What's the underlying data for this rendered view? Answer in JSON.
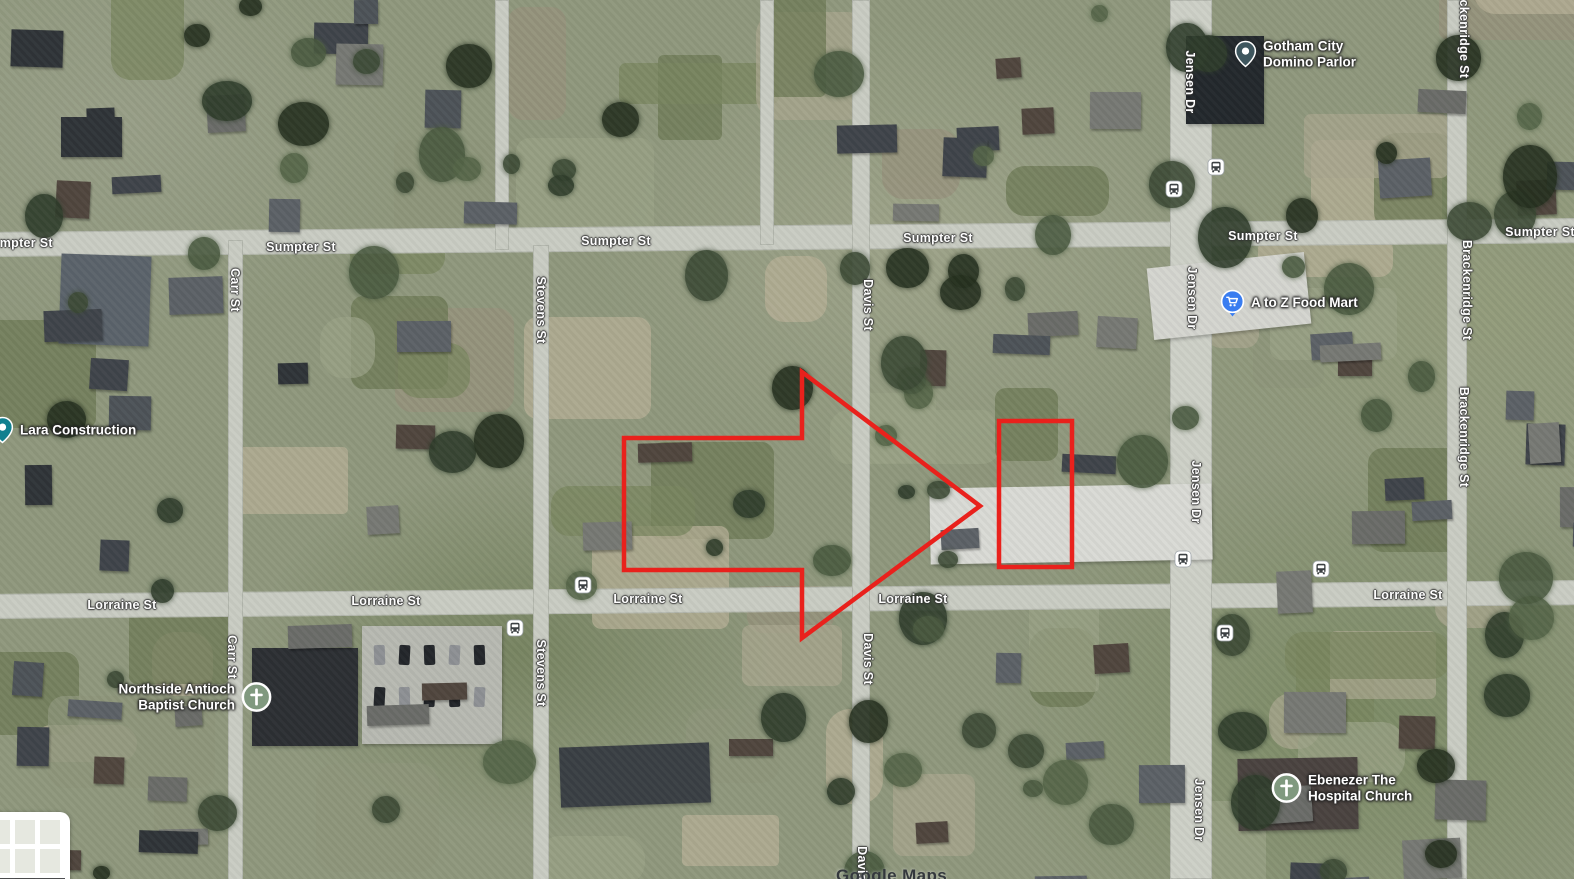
{
  "map": {
    "watermark": "Google Maps"
  },
  "annotations": {
    "color": "#e9211c",
    "stroke_width": 4.5,
    "arrow_polygon_points": "624,438 802,438 802,372 980,506 802,638 802,570 624,570",
    "parcel_rect": {
      "x": 999,
      "y": 421,
      "width": 73,
      "height": 146
    }
  },
  "street_labels": [
    {
      "text": "Sumpter St",
      "x": 18,
      "y": 243,
      "orientation": "horizontal"
    },
    {
      "text": "Sumpter St",
      "x": 301,
      "y": 247,
      "orientation": "horizontal"
    },
    {
      "text": "Sumpter St",
      "x": 616,
      "y": 241,
      "orientation": "horizontal"
    },
    {
      "text": "Sumpter St",
      "x": 938,
      "y": 238,
      "orientation": "horizontal"
    },
    {
      "text": "Sumpter St",
      "x": 1263,
      "y": 236,
      "orientation": "horizontal"
    },
    {
      "text": "Sumpter St",
      "x": 1540,
      "y": 232,
      "orientation": "horizontal"
    },
    {
      "text": "Lorraine St",
      "x": 122,
      "y": 605,
      "orientation": "horizontal"
    },
    {
      "text": "Lorraine St",
      "x": 386,
      "y": 601,
      "orientation": "horizontal"
    },
    {
      "text": "Lorraine St",
      "x": 648,
      "y": 599,
      "orientation": "horizontal"
    },
    {
      "text": "Lorraine St",
      "x": 913,
      "y": 599,
      "orientation": "horizontal"
    },
    {
      "text": "Lorraine St",
      "x": 1408,
      "y": 595,
      "orientation": "horizontal"
    },
    {
      "text": "Carr St",
      "x": 235,
      "y": 290,
      "orientation": "vertical"
    },
    {
      "text": "Carr St",
      "x": 232,
      "y": 657,
      "orientation": "vertical"
    },
    {
      "text": "Stevens St",
      "x": 541,
      "y": 310,
      "orientation": "vertical"
    },
    {
      "text": "Stevens St",
      "x": 541,
      "y": 673,
      "orientation": "vertical"
    },
    {
      "text": "Davis St",
      "x": 868,
      "y": 305,
      "orientation": "vertical"
    },
    {
      "text": "Davis St",
      "x": 868,
      "y": 659,
      "orientation": "vertical"
    },
    {
      "text": "Davis St",
      "x": 862,
      "y": 872,
      "orientation": "vertical"
    },
    {
      "text": "Jensen Dr",
      "x": 1190,
      "y": 82,
      "orientation": "vertical"
    },
    {
      "text": "Jensen Dr",
      "x": 1192,
      "y": 298,
      "orientation": "vertical"
    },
    {
      "text": "Jensen Dr",
      "x": 1196,
      "y": 492,
      "orientation": "vertical"
    },
    {
      "text": "Jensen Dr",
      "x": 1199,
      "y": 810,
      "orientation": "vertical"
    },
    {
      "text": "Brackenridge St",
      "x": 1464,
      "y": 28,
      "orientation": "vertical"
    },
    {
      "text": "Brackenridge St",
      "x": 1467,
      "y": 290,
      "orientation": "vertical"
    },
    {
      "text": "Brackenridge St",
      "x": 1464,
      "y": 437,
      "orientation": "vertical"
    }
  ],
  "places": [
    {
      "name": "Gotham City Domino Parlor",
      "lines": [
        "Gotham City",
        "Domino Parlor"
      ],
      "icon": "place-pin",
      "icon_color": "#3e565e",
      "x": 1247,
      "y": 54,
      "text_side": "right"
    },
    {
      "name": "A to Z Food Mart",
      "lines": [
        "A to Z Food Mart"
      ],
      "icon": "shopping-cart-pin",
      "icon_color": "#3a7df0",
      "x": 1233,
      "y": 303,
      "text_side": "right"
    },
    {
      "name": "Lara Construction",
      "lines": [
        "Lara Construction"
      ],
      "icon": "place-pin",
      "icon_color": "#11808f",
      "x": 4,
      "y": 430,
      "text_side": "right"
    },
    {
      "name": "Northside Antioch Baptist Church",
      "lines": [
        "Northside Antioch",
        "Baptist Church"
      ],
      "icon": "church-cross",
      "icon_color": "#80997f",
      "x": 256,
      "y": 697,
      "text_side": "left"
    },
    {
      "name": "Ebenezer The Hospital Church",
      "lines": [
        "Ebenezer The",
        "Hospital Church"
      ],
      "icon": "church-cross",
      "icon_color": "#80997f",
      "x": 1284,
      "y": 788,
      "text_side": "right"
    }
  ],
  "transit_stops": [
    {
      "x": 583,
      "y": 585
    },
    {
      "x": 515,
      "y": 628
    },
    {
      "x": 1216,
      "y": 167
    },
    {
      "x": 1174,
      "y": 189
    },
    {
      "x": 1183,
      "y": 559
    },
    {
      "x": 1225,
      "y": 633
    },
    {
      "x": 1321,
      "y": 569
    }
  ],
  "layers_control": {
    "label": "Layers"
  }
}
